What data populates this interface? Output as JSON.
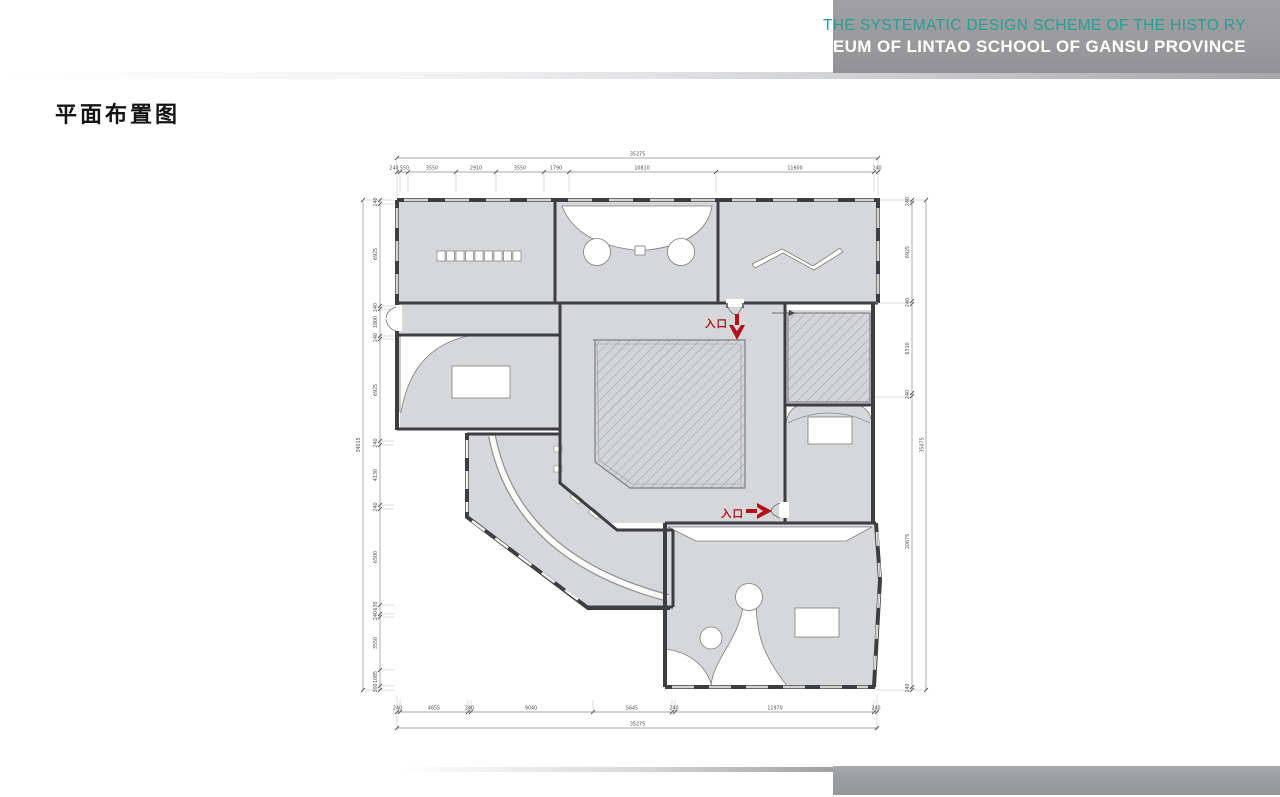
{
  "header": {
    "line1": "THE SYSTEMATIC DESIGN SCHEME OF THE HISTO RY",
    "line2": "MUSEUM OF LINTAO SCHOOL OF GANSU PROVINCE",
    "line1_color": "#24a099",
    "line2_color": "#ffffff",
    "bar_color": "#9b9b9d"
  },
  "title": "平面布置图",
  "plan": {
    "entrance_top_label": "入口",
    "entrance_side_label": "入口",
    "accent_red": "#b1121a",
    "wall_color": "#3d3e40",
    "room_fill": "#d6d7d9",
    "dims": {
      "top_total": "35275",
      "bottom_total": "35275",
      "left_total": "34015",
      "right_total": "35075",
      "top": [
        "240",
        "550",
        "3550",
        "2910",
        "3550",
        "1790",
        "10810",
        "11600",
        "240"
      ],
      "bottom": [
        "240",
        "4655",
        "240",
        "9040",
        "5645",
        "240",
        "11970",
        "240"
      ],
      "left": [
        "240",
        "6925",
        "240",
        "1800",
        "240",
        "6925",
        "240",
        "4130",
        "240",
        "6500",
        "630",
        "240",
        "3550",
        "1085",
        "300"
      ],
      "right": [
        "240",
        "6925",
        "240",
        "6310",
        "240",
        "20675",
        "240"
      ]
    }
  }
}
